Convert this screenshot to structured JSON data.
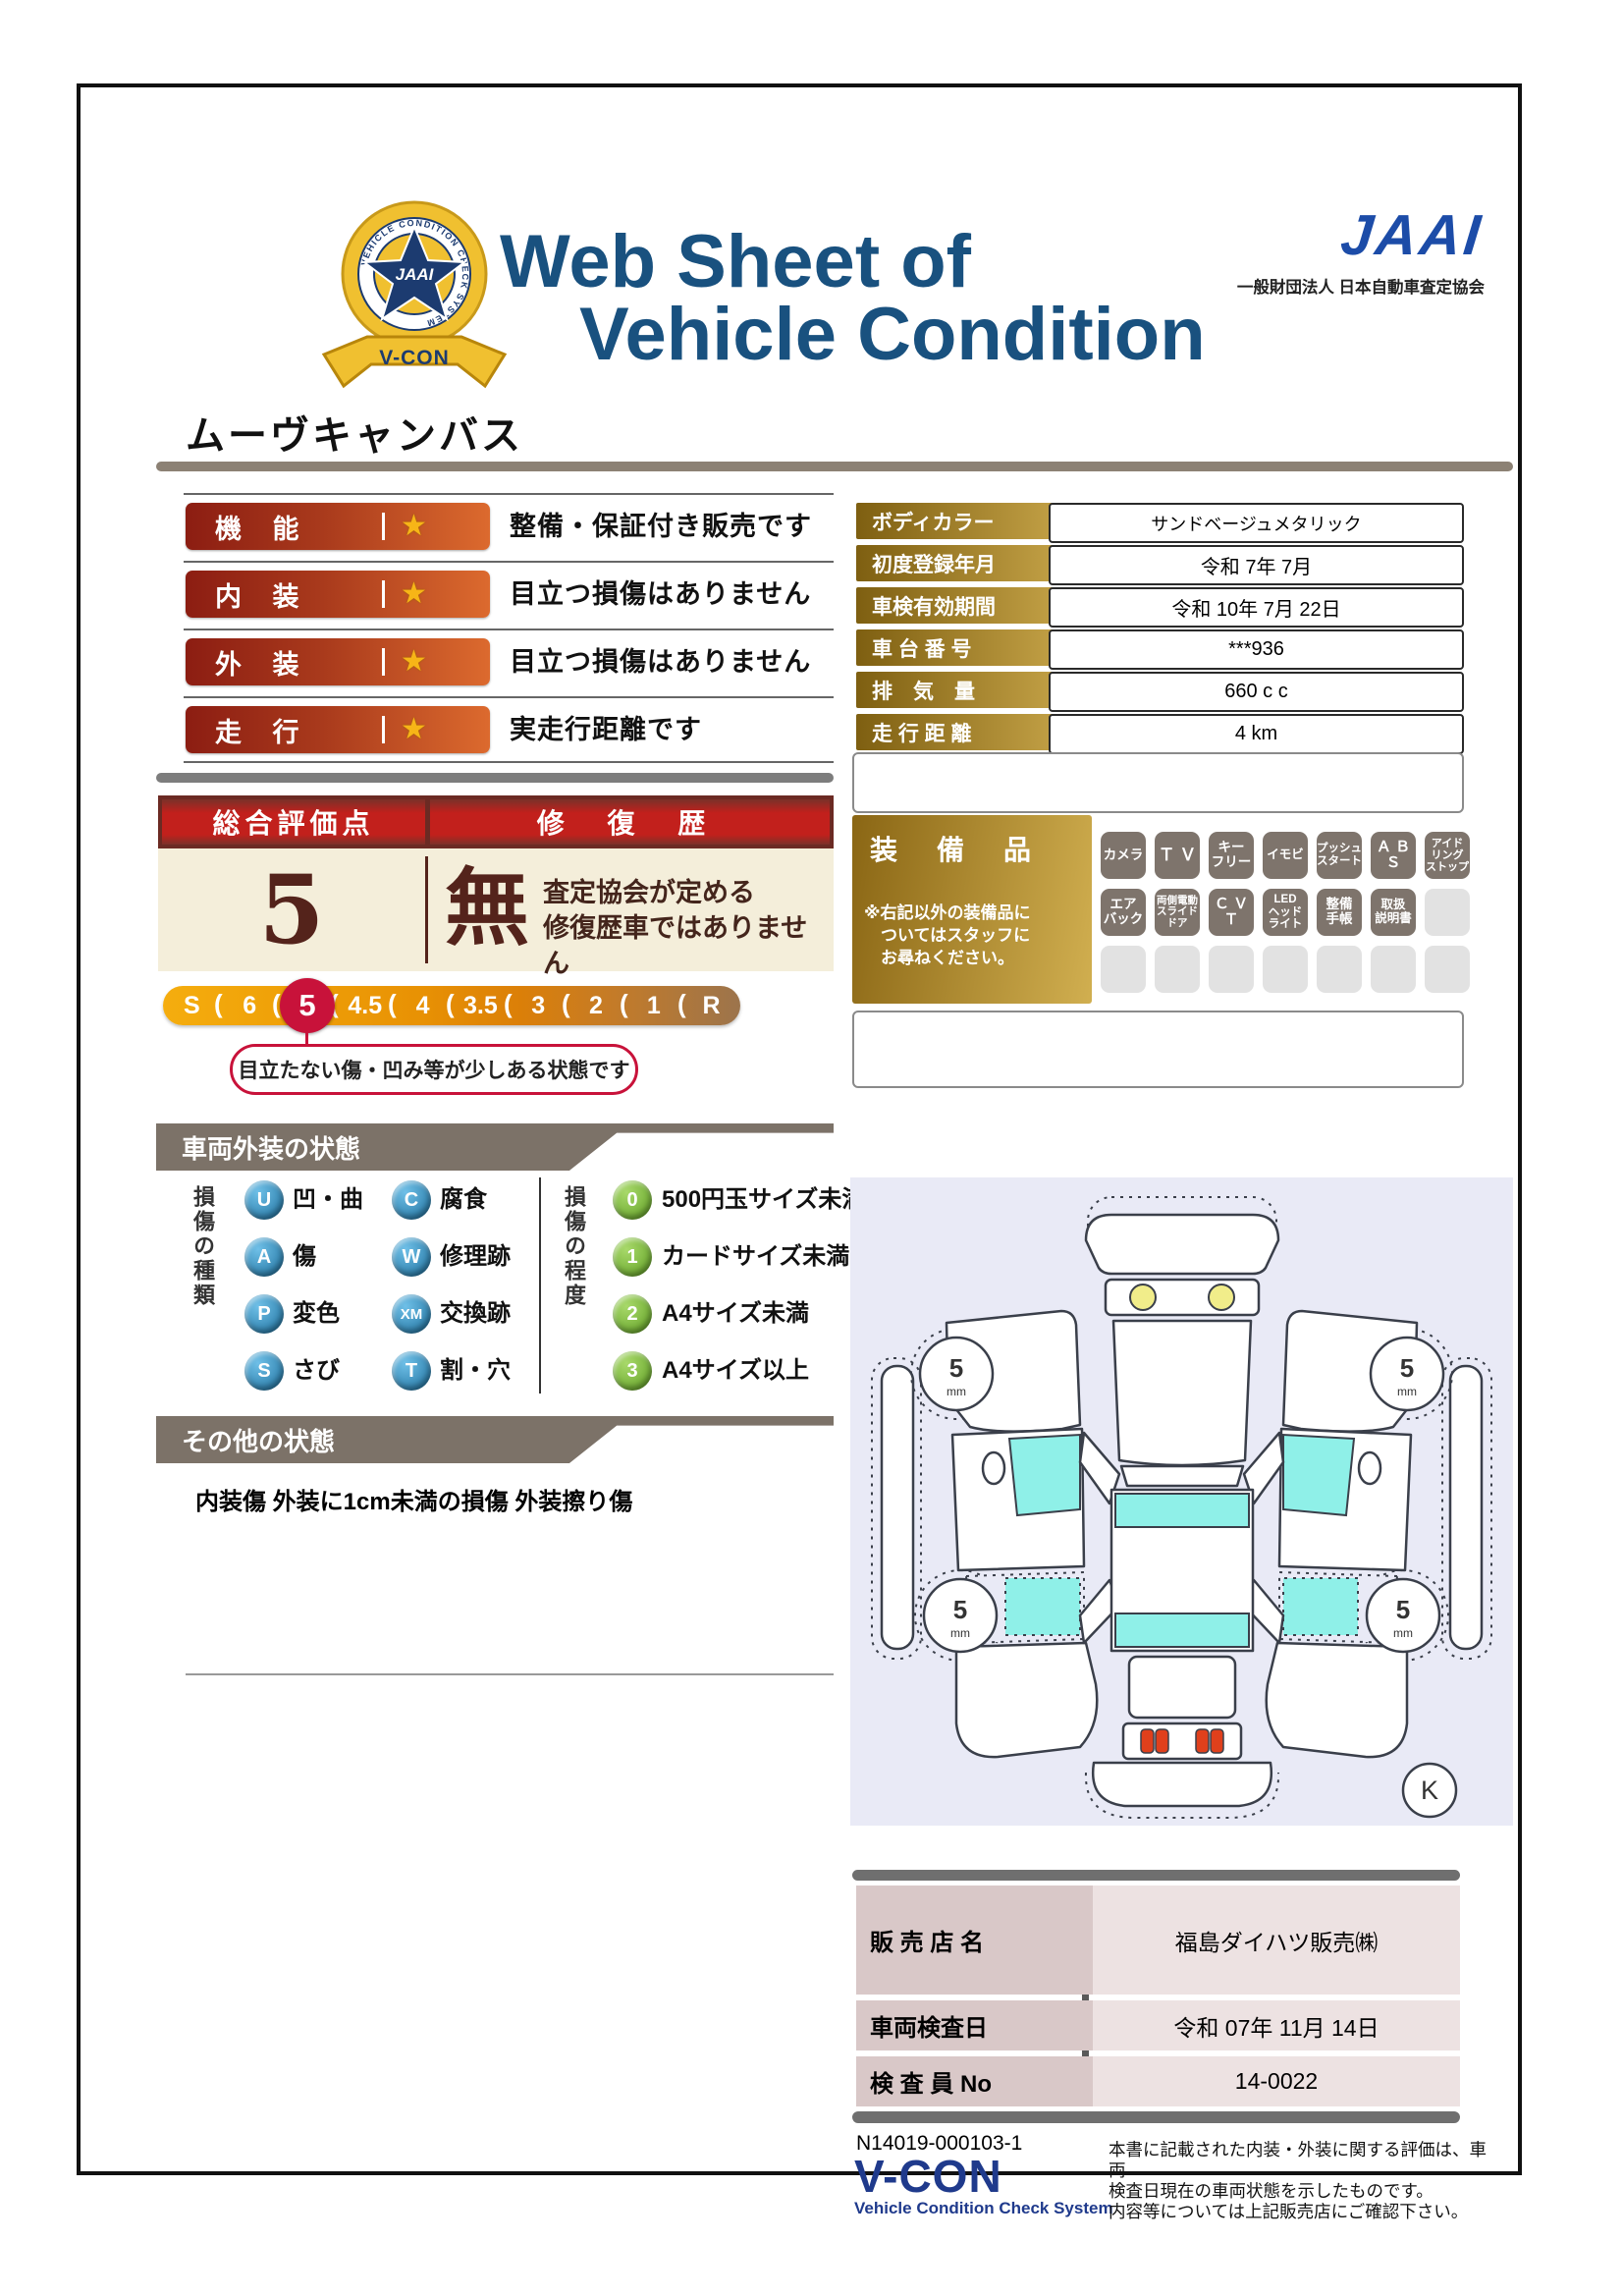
{
  "colors": {
    "title_navy": "#19517F",
    "jaai_blue": "#1C4CA8",
    "badge_red": "#8C1D12",
    "badge_orange": "#DC6A2E",
    "crimson": "#C8123A",
    "gold": "#C3A146",
    "cream": "#F4EEDA",
    "section_gray": "#7C7268",
    "diagram_bg": "#E9EAF6",
    "window_cyan": "#8FF0E8",
    "vcon_navy": "#1F3A8C"
  },
  "header": {
    "title_line1": "Web Sheet of",
    "title_line2": "Vehicle Condition",
    "jaai_logo": "JAAI",
    "jaai_org": "一般財団法人 日本自動車査定協会",
    "emblem_jaai": "JAAI",
    "emblem_ring": "VEHICLE CONDITION CHECK SYSTEM",
    "emblem_vcon": "V-CON",
    "vehicle_name": "ムーヴキャンバス"
  },
  "ratings": {
    "star": "★",
    "rows": [
      {
        "label": "機 能",
        "text": "整備・保証付き販売です"
      },
      {
        "label": "内 装",
        "text": "目立つ損傷はありません"
      },
      {
        "label": "外 装",
        "text": "目立つ損傷はありません"
      },
      {
        "label": "走 行",
        "text": "実走行距離です"
      }
    ]
  },
  "summary": {
    "title": "総合評価点",
    "repair_title": "修 復 歴",
    "score": "5",
    "repair_value": "無",
    "repair_desc1": "査定協会が定める",
    "repair_desc2": "修復歴車ではありません"
  },
  "scale": {
    "items": [
      "S",
      "6",
      "5",
      "4.5",
      "4",
      "3.5",
      "3",
      "2",
      "1",
      "R"
    ],
    "highlight": "5",
    "separator": "(",
    "bubble": "目立たない傷・凹み等が少しある状態です"
  },
  "vehicle_info": {
    "rows": [
      {
        "label": "ボディカラー",
        "value": "サンドベージュメタリック"
      },
      {
        "label": "初度登録年月",
        "value": "令和 7年 7月"
      },
      {
        "label": "車検有効期間",
        "value": "令和 10年 7月 22日"
      },
      {
        "label": "車 台 番 号",
        "value": "***936"
      },
      {
        "label": "排　気　量",
        "value": "660 c c"
      },
      {
        "label": "走 行 距 離",
        "value": "4 km"
      }
    ]
  },
  "equipment": {
    "title": "装　備　品",
    "note1": "※右記以外の装備品に",
    "note2": "　ついてはスタッフに",
    "note3": "　お尋ねください。",
    "badges": [
      "カメラ",
      "Ｔ Ｖ",
      "キー\nフリー",
      "イモビ",
      "プッシュ\nスタート",
      "Ａ Ｂ Ｓ",
      "アイド\nリング\nストップ",
      "エア\nバック",
      "両側電動\nスライド\nドア",
      "Ｃ Ｖ Ｔ",
      "LED\nヘッド\nライト",
      "整備\n手帳",
      "取扱\n説明書"
    ]
  },
  "exterior": {
    "header": "車両外装の状態",
    "type_title": "損傷の種類",
    "degree_title": "損傷の程度",
    "types": [
      {
        "code": "U",
        "label": "凹・曲"
      },
      {
        "code": "C",
        "label": "腐食"
      },
      {
        "code": "A",
        "label": "傷"
      },
      {
        "code": "W",
        "label": "修理跡"
      },
      {
        "code": "P",
        "label": "変色"
      },
      {
        "code": "XM",
        "label": "交換跡"
      },
      {
        "code": "S",
        "label": "さび"
      },
      {
        "code": "T",
        "label": "割・穴"
      }
    ],
    "degrees": [
      {
        "code": "0",
        "label": "500円玉サイズ未満"
      },
      {
        "code": "1",
        "label": "カードサイズ未満"
      },
      {
        "code": "2",
        "label": "A4サイズ未満"
      },
      {
        "code": "3",
        "label": "A4サイズ以上"
      }
    ]
  },
  "other": {
    "header": "その他の状態",
    "note": "内装傷 外装に1cm未満の損傷 外装擦り傷"
  },
  "diagram": {
    "tire_depth": "5",
    "tire_unit": "mm",
    "plate": "K"
  },
  "dealer": {
    "rows": [
      {
        "label": "販 売 店 名",
        "value": "福島ダイハツ販売㈱"
      },
      {
        "label": "車両検査日",
        "value": "令和 07年 11月 14日"
      },
      {
        "label": "検 査 員 No",
        "value": "14-0022"
      }
    ]
  },
  "footer": {
    "doc_no": "N14019-000103-1",
    "vcon": "V-CON",
    "vcon_sub": "Vehicle Condition Check System",
    "disc1": "本書に記載された内装・外装に関する評価は、車両",
    "disc2": "検査日現在の車両状態を示したものです。",
    "disc3": "内容等については上記販売店にご確認下さい。"
  }
}
